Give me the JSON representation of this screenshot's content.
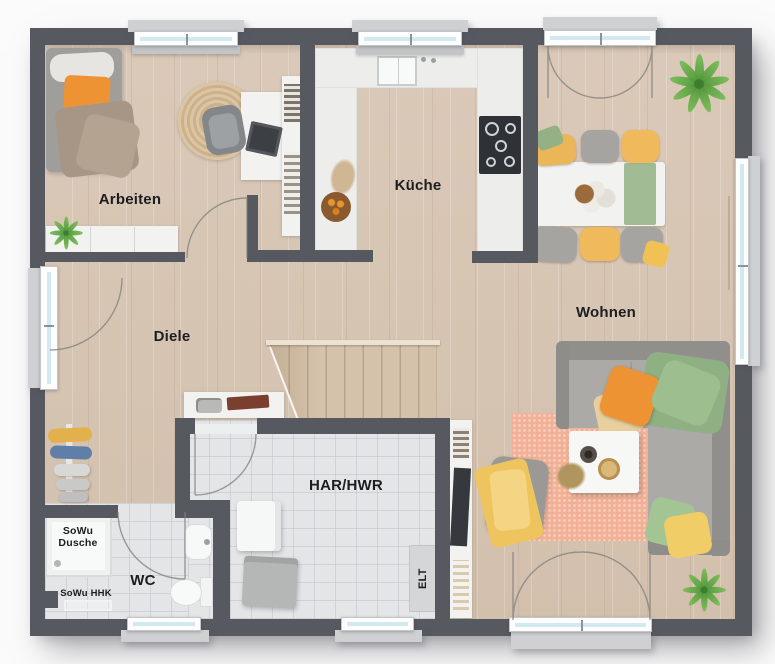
{
  "rooms": {
    "arbeiten": {
      "label": "Arbeiten"
    },
    "kueche": {
      "label": "Küche"
    },
    "wohnen": {
      "label": "Wohnen"
    },
    "diele": {
      "label": "Diele"
    },
    "har": {
      "label": "HAR/HWR"
    },
    "wc": {
      "label": "WC"
    }
  },
  "annotations": {
    "shower": {
      "label": "SoWu Dusche"
    },
    "radiator": {
      "label": "SoWu HHK"
    },
    "electrical": {
      "label": "ELT"
    }
  },
  "colors": {
    "wall": "#565a60",
    "wood_floor": "#d8c6b4",
    "tile_floor": "#e4e5e7",
    "window_glass": "#d2e9f2",
    "accent_orange": "#ee9334",
    "accent_yellow": "#eec45f",
    "accent_green": "#93b184",
    "rug_peach": "#f2b196"
  }
}
